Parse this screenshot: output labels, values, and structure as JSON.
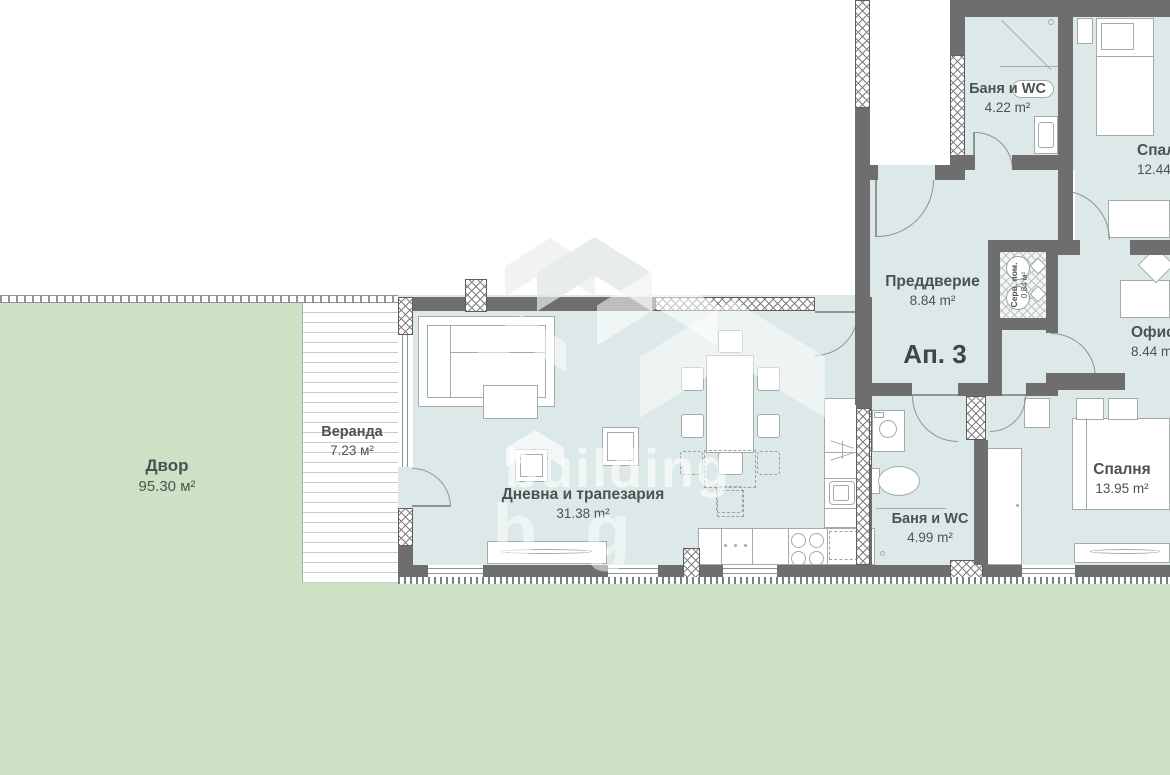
{
  "watermark": {
    "line1": "building",
    "line2": "bg"
  },
  "apartment_label": "Ап. 3",
  "rooms": {
    "yard": {
      "name": "Двор",
      "area": "95.30 м²"
    },
    "veranda": {
      "name": "Веранда",
      "area": "7.23 м²"
    },
    "living": {
      "name": "Дневна и трапезария",
      "area": "31.38 m²"
    },
    "entry": {
      "name": "Преддверие",
      "area": "8.84 m²"
    },
    "bath_top": {
      "name": "Баня и WC",
      "area": "4.22 m²"
    },
    "bedroom_top": {
      "name": "Спалня",
      "area": "12.44 m²"
    },
    "office": {
      "name": "Офис",
      "area": "8.44 m²"
    },
    "service": {
      "name": "Серв. пом.",
      "area": "0.84 м²"
    },
    "bath_bottom": {
      "name": "Баня и WC",
      "area": "4.99 m²"
    },
    "bedroom_bottom": {
      "name": "Спалня",
      "area": "13.95 m²"
    }
  },
  "colors": {
    "floor": "#dde9e8",
    "yard": "#cde2c5",
    "wall": "#6e6e6e"
  }
}
